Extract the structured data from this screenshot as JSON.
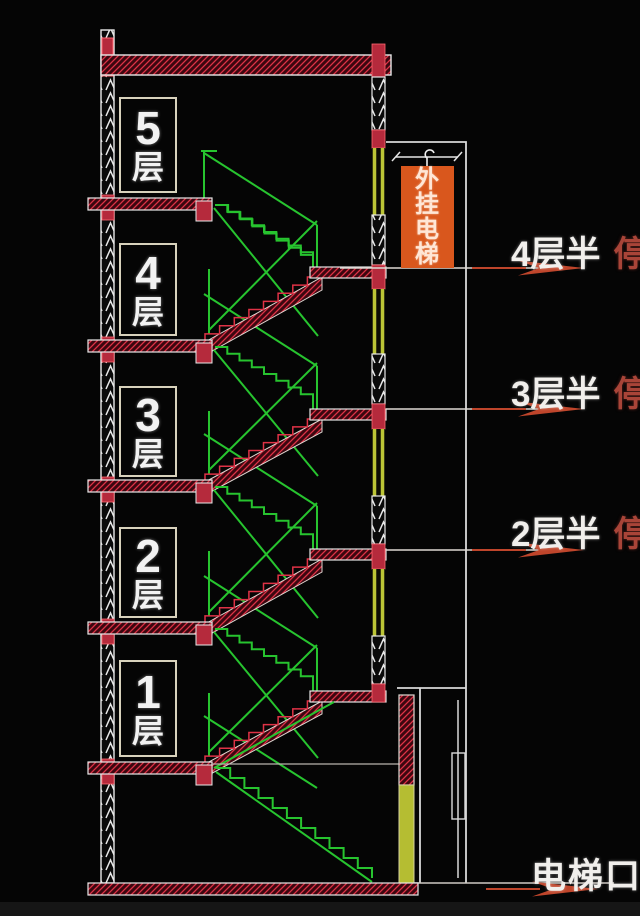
{
  "diagram": {
    "floor_labels": [
      {
        "num": "5",
        "unit": "层"
      },
      {
        "num": "4",
        "unit": "层"
      },
      {
        "num": "3",
        "unit": "层"
      },
      {
        "num": "2",
        "unit": "层"
      },
      {
        "num": "1",
        "unit": "层"
      }
    ],
    "elevator_box_label": "外挂电梯",
    "stops": [
      {
        "level": "4层半",
        "status": "停"
      },
      {
        "level": "3层半",
        "status": "停"
      },
      {
        "level": "2层半",
        "status": "停"
      }
    ],
    "entrance_label": "电梯口",
    "colors": {
      "background": "#050505",
      "structure_red": "#df3246",
      "stair_green": "#27c42f",
      "rail_yellow": "#bcc536",
      "elevator_box_orange": "#d9571d",
      "stop_text_red": "#a84438",
      "arrow_red": "#bf452b",
      "line_white": "#e6e6e6"
    }
  }
}
